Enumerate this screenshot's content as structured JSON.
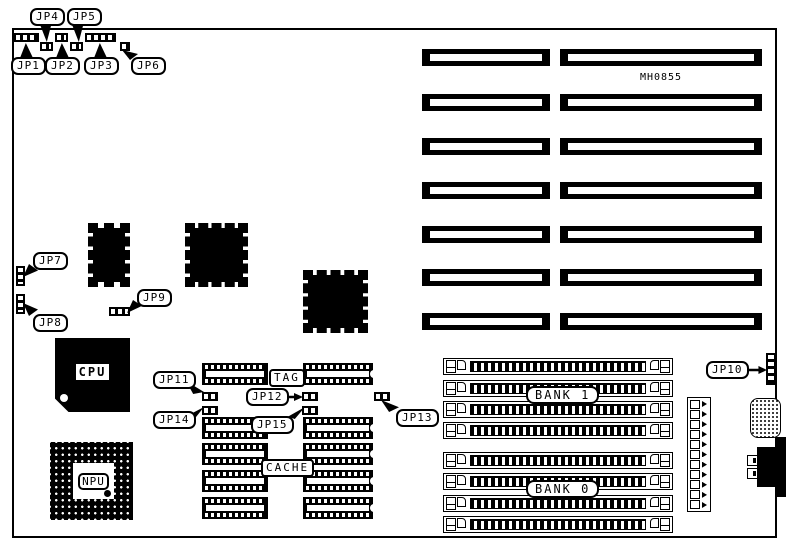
{
  "part_number": "MH0855",
  "labels": {
    "jp1": "JP1",
    "jp2": "JP2",
    "jp3": "JP3",
    "jp4": "JP4",
    "jp5": "JP5",
    "jp6": "JP6",
    "jp7": "JP7",
    "jp8": "JP8",
    "jp9": "JP9",
    "jp10": "JP10",
    "jp11": "JP11",
    "jp12": "JP12",
    "jp13": "JP13",
    "jp14": "JP14",
    "jp15": "JP15"
  },
  "chips": {
    "cpu": "CPU",
    "npu": "NPU"
  },
  "memory": {
    "tag": "TAG",
    "cache": "CACHE",
    "bank0": "BANK 0",
    "bank1": "BANK 1"
  },
  "colors": {
    "ink": "#000000",
    "paper": "#ffffff"
  }
}
